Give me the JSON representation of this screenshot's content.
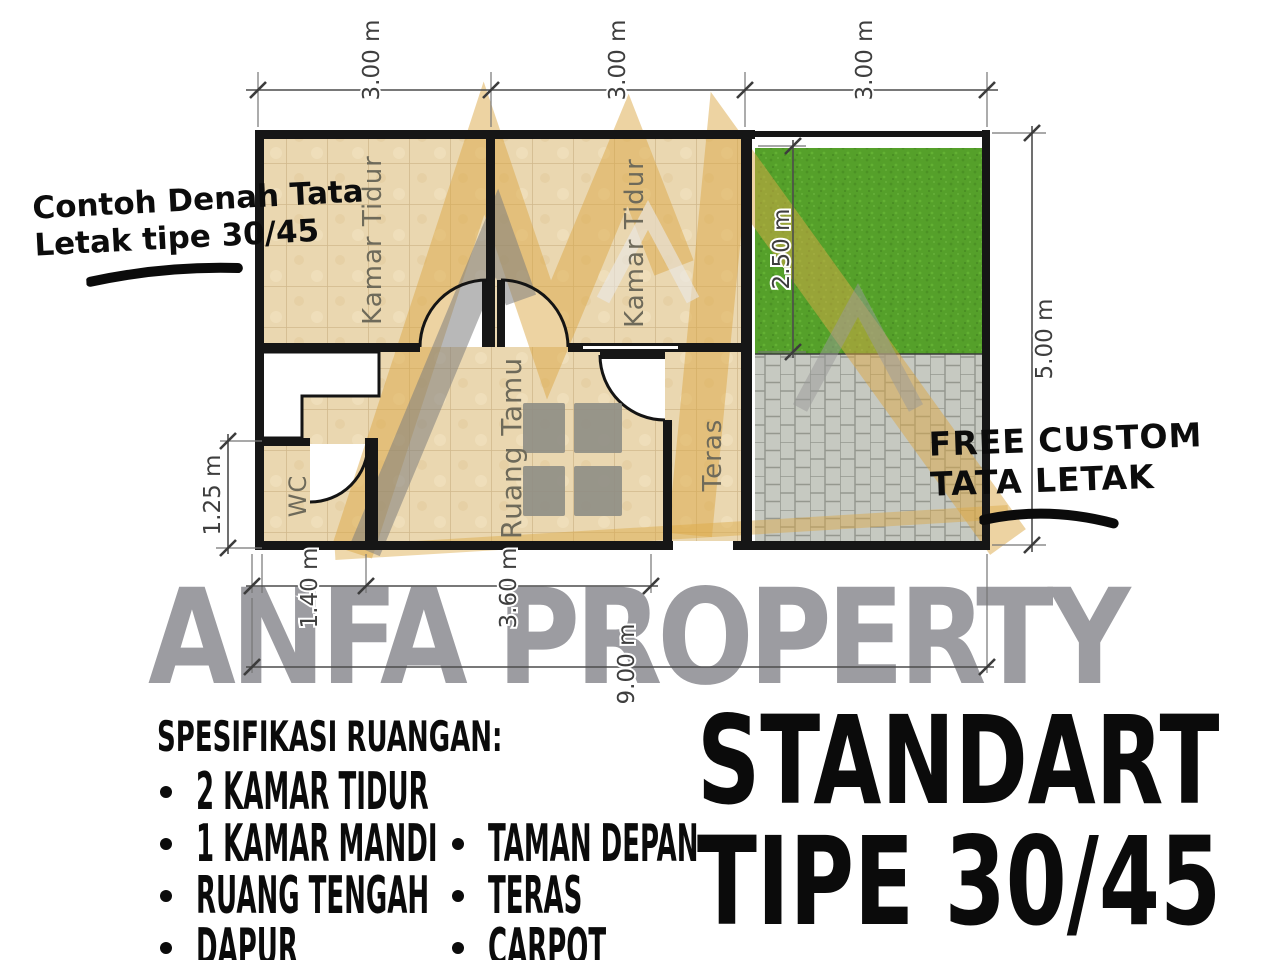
{
  "annotations": {
    "sketch_note": {
      "line1": "Contoh Denah Tata",
      "line2": "Letak tipe 30/45"
    },
    "free_custom_note": {
      "line1": "FREE CUSTOM",
      "line2": "TATA LETAK"
    }
  },
  "watermark": {
    "brand": "ANFA PROPERTY"
  },
  "floor_plan": {
    "rooms": {
      "bedroom_left": "Kamar Tidur",
      "bedroom_right": "Kamar Tidur",
      "living_room": "Ruang Tamu",
      "wc": "WC",
      "terrace": "Teras"
    },
    "dimensions": {
      "top_segments": [
        "3.00 m",
        "3.00 m",
        "3.00 m"
      ],
      "right_total": "5.00 m",
      "garden_depth": "2.50 m",
      "left_wc": "1.25 m",
      "bottom_seg1": "1.40 m",
      "bottom_seg2": "3.60 m",
      "bottom_total": "9.00 m"
    }
  },
  "specs": {
    "heading": "SPESIFIKASI RUANGAN:",
    "column_left": [
      "2 KAMAR TIDUR",
      "1 KAMAR MANDI",
      "RUANG TENGAH",
      "DAPUR"
    ],
    "column_right": [
      "TAMAN DEPAN",
      "TERAS",
      "CARPOT"
    ]
  },
  "title": {
    "line1": "STANDART",
    "line2": "TIPE 30/45"
  },
  "colors": {
    "tile": "#ead7b0",
    "tile_grout": "#c8ae80",
    "grass": "#55a02a",
    "paver": "#c6c9c1",
    "logo_gold": "#dca845",
    "logo_gray": "#7d7d7d",
    "watermark_gray": "#95959a",
    "wall": "#161616",
    "ink": "#0c0c0c"
  }
}
